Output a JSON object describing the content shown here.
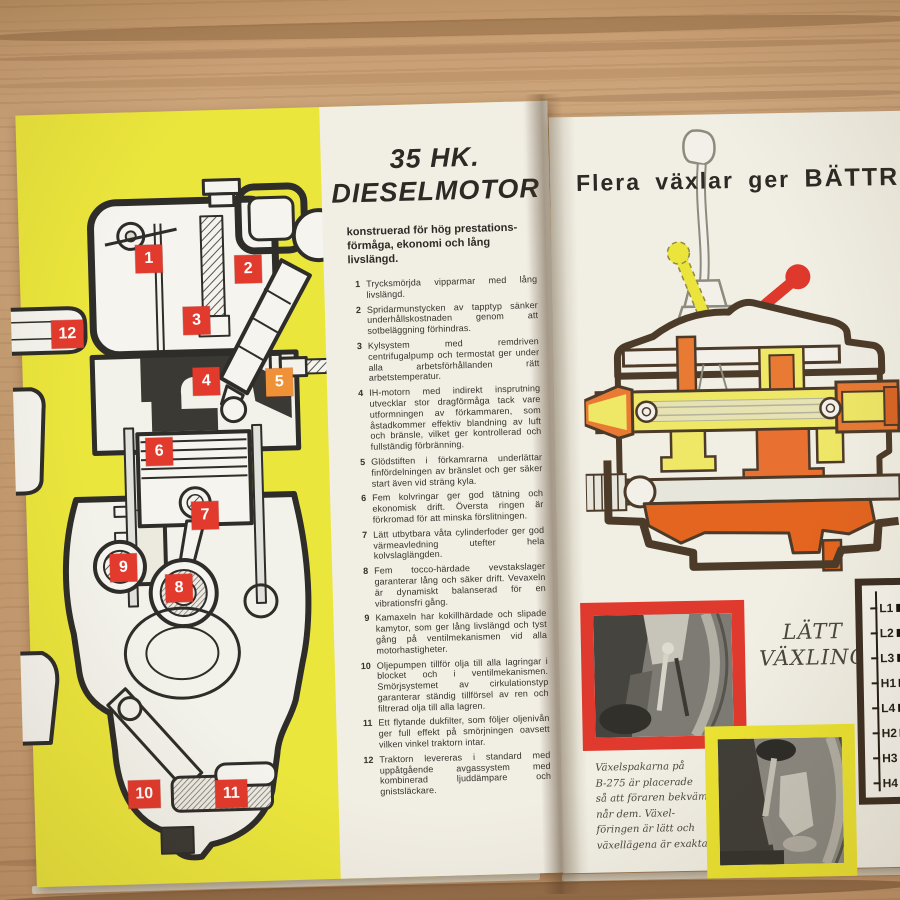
{
  "left_page": {
    "engine_labels": [
      "1",
      "2",
      "3",
      "4",
      "5",
      "6",
      "7",
      "8",
      "9",
      "10",
      "11",
      "12"
    ],
    "title_line1": "35 HK.",
    "title_line2": "DIESELMOTOR",
    "intro": "konstruerad för hög prestations-förmåga, ekonomi och lång livslängd.",
    "features": [
      {
        "num": "1",
        "text": "Trycksmörjda vipparmar med lång livslängd."
      },
      {
        "num": "2",
        "text": "Spridarmunstycken av tapptyp sänker underhållskostnaden genom att sotbeläggning förhindras."
      },
      {
        "num": "3",
        "text": "Kylsystem med remdriven centrifugalpump och termostat ger under alla arbetsförhållanden rätt arbetstemperatur."
      },
      {
        "num": "4",
        "text": "IH-motorn med indirekt insprutning utvecklar stor dragförmåga tack vare utformningen av förkammaren, som åstadkommer effektiv blandning av luft och bränsle, vilket ger kontrollerad och fullständig förbränning."
      },
      {
        "num": "5",
        "text": "Glödstiften i förkamrarna underlättar finfördelningen av bränslet och ger säker start även vid sträng kyla."
      },
      {
        "num": "6",
        "text": "Fem kolvringar ger god tätning och ekonomisk drift. Översta ringen är förkromad för att minska förslitningen."
      },
      {
        "num": "7",
        "text": "Lätt utbytbara våta cylinderfoder ger god värmeavledning utefter hela kolvslaglängden."
      },
      {
        "num": "8",
        "text": "Fem tocco-härdade vevstakslager garanterar lång och säker drift. Vevaxeln är dynamiskt balanserad för en vibrationsfri gång."
      },
      {
        "num": "9",
        "text": "Kamaxeln har kokillhärdade och slipade kamytor, som ger lång livslängd och tyst gång på ventilmekanismen vid alla motorhastigheter."
      },
      {
        "num": "10",
        "text": "Oljepumpen tillför olja till alla lagringar i blocket och i ventilmekanismen. Smörjsystemet av cirkulationstyp garanterar ständig tillförsel av ren och filtrerad olja till alla lagren."
      },
      {
        "num": "11",
        "text": "Ett flytande dukfilter, som följer oljenivån ger full effekt på smörjningen oavsett vilken vinkel traktorn intar."
      },
      {
        "num": "12",
        "text": "Traktorn levereras i standard med uppåtgående avgassystem med kombinerad ljuddämpare och gnistsläckare."
      }
    ]
  },
  "right_page": {
    "headline_regular": "Flera växlar ger",
    "headline_caps": "BÄTTRE ARB",
    "easy_shift_line1": "LÄTT",
    "easy_shift_line2": "VÄXLING",
    "gear_positions": [
      "L1",
      "L2",
      "L3",
      "H1",
      "L4",
      "H2",
      "H3",
      "H4"
    ],
    "caption_lines": [
      "Växelspakarna på",
      "B-275 är placerade",
      "så att föraren bekvämt",
      "når dem. Växel-",
      "föringen är lätt och",
      "växellägena är exakta."
    ]
  },
  "colors": {
    "page_yellow": "#ebe63c",
    "label_red": "#e23a2c",
    "label_orange": "#ef9137",
    "photo_frame_red": "#e0392d",
    "photo_frame_yellow": "#ece432",
    "lever_red": "#df382c",
    "lever_yellow": "#ebe43c",
    "diagram_orange": "#e87a33",
    "diagram_yellow": "#efe766",
    "table_wood": "#c89e73"
  }
}
